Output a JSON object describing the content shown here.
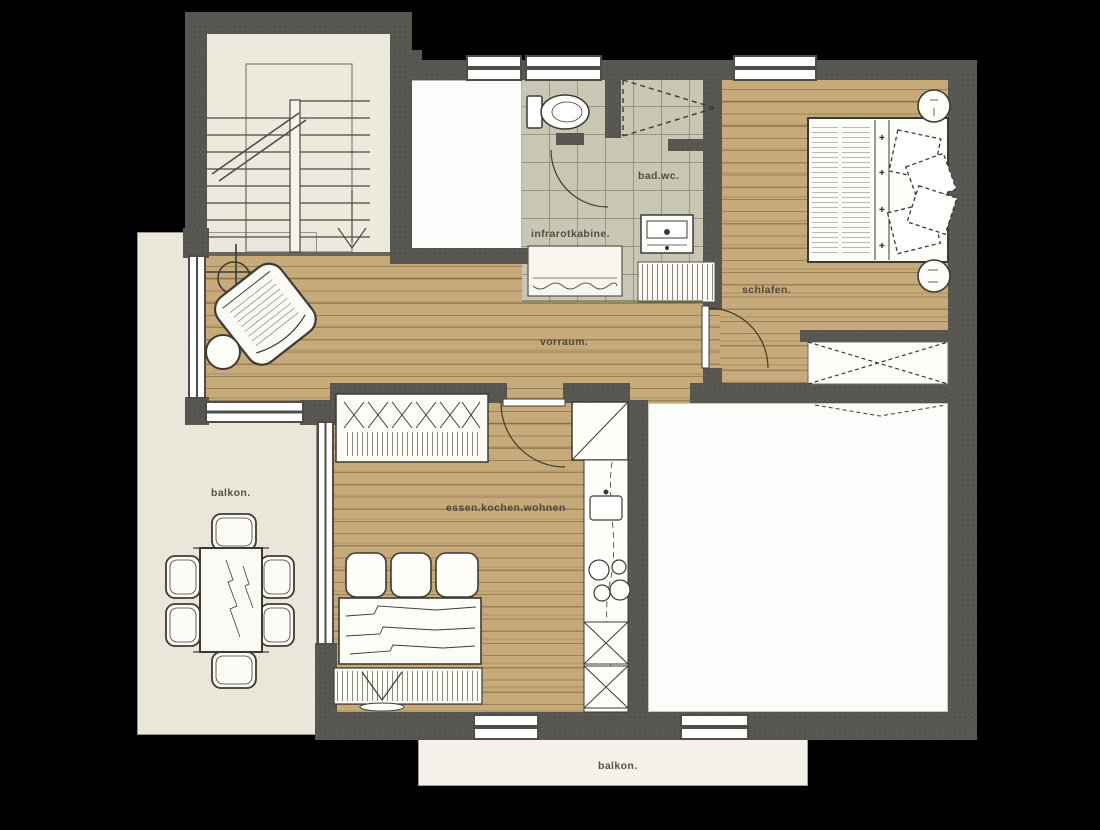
{
  "plan": {
    "labels": {
      "bathroom": "bad.wc.",
      "infrared_cabin": "infrarotkabine.",
      "bedroom": "schlafen.",
      "hallway": "vorraum.",
      "balcony_left": "balkon.",
      "living": "essen.kochen.wohnen",
      "balcony_bottom": "balkon."
    },
    "colors": {
      "background": "#000000",
      "wall": "#565550",
      "wood_floor": "#c2a470",
      "tile_floor": "#c9c6b4",
      "balcony_floor": "#eae6da",
      "stair_floor": "#ece9dd",
      "white_room": "#fdfdfc",
      "line": "#3c3b33",
      "label_text": "#3e3c34"
    }
  }
}
